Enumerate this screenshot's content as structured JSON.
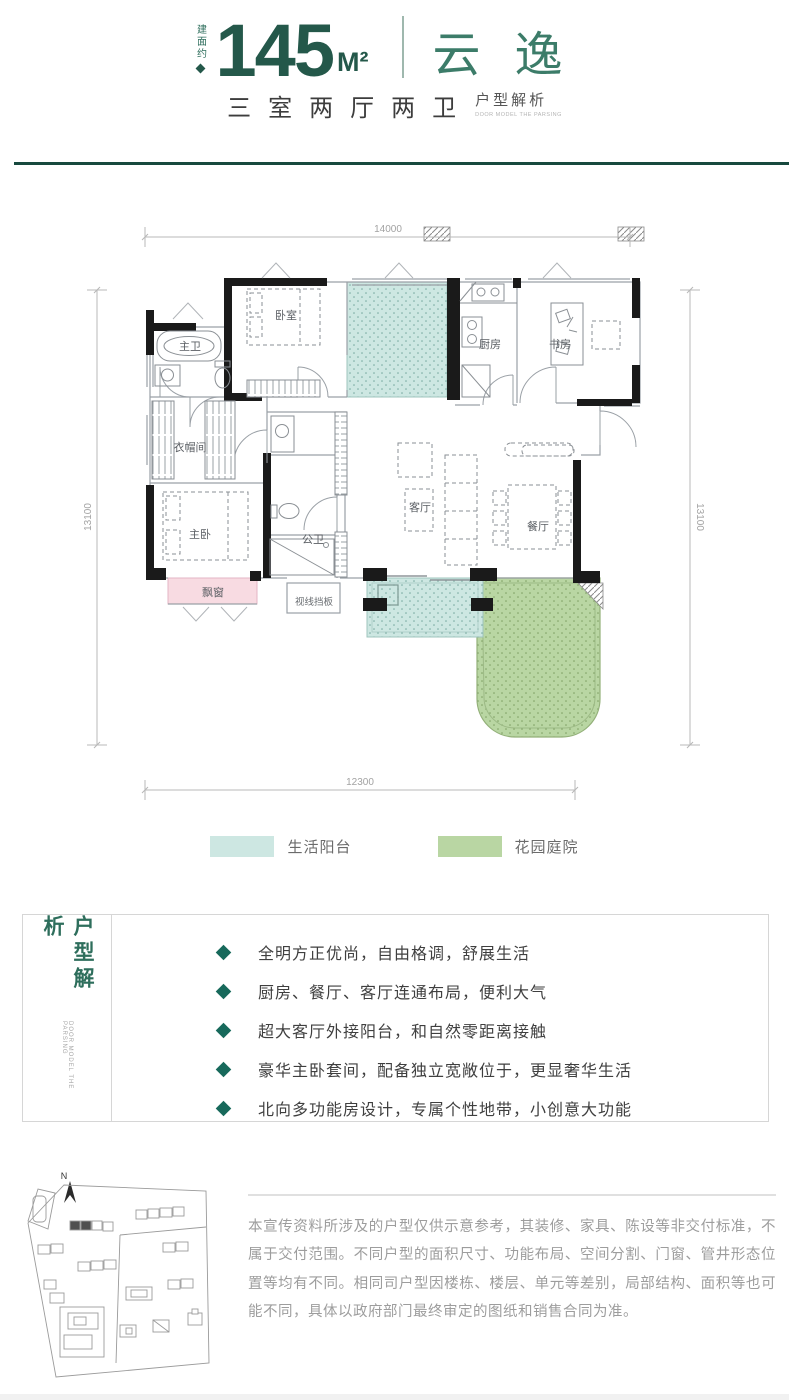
{
  "colors": {
    "accent_dark": "#24584a",
    "accent": "#2e6e5c",
    "rule_green": "#17493e",
    "balcony_teal": "#cde7e2",
    "garden_green": "#b9d6a3",
    "bay_pink": "#f8dbe2",
    "wall_black": "#1a1a1a",
    "bullet_teal": "#17695b"
  },
  "header": {
    "area_label": "建面约",
    "area_value": "145",
    "area_unit": "M²",
    "plan_name": "云逸",
    "subtitle": "三室两厅两卫",
    "subtitle_tag": "户型解析",
    "subtitle_tag_en": "DOOR MODEL THE PARSING"
  },
  "floorplan": {
    "dims": {
      "top": "14000",
      "bottom": "12300",
      "left": "13100",
      "right": "13100"
    },
    "rooms": {
      "master_bath": "主卫",
      "bedroom": "卧室",
      "kitchen": "厨房",
      "study": "书房",
      "cloakroom": "衣帽间",
      "master_bedroom": "主卧",
      "guest_bath": "公卫",
      "living_room": "客厅",
      "dining_room": "餐厅",
      "bay_window": "飘窗",
      "sight_baffle": "视线挡板"
    }
  },
  "legend": {
    "balcony": "生活阳台",
    "garden": "花园庭院"
  },
  "analysis": {
    "title": "户型解析",
    "title_en": "DOOR MODEL THE PARSING",
    "bullets": [
      "全明方正优尚，自由格调，舒展生活",
      "厨房、餐厅、客厅连通布局，便利大气",
      "超大客厅外接阳台，和自然零距离接触",
      "豪华主卧套间，配备独立宽敞位于，更显奢华生活",
      "北向多功能房设计，专属个性地带，小创意大功能"
    ]
  },
  "siteplan": {
    "compass": "N"
  },
  "disclaimer": "本宣传资料所涉及的户型仅供示意参考，其装修、家具、陈设等非交付标准，不属于交付范围。不同户型的面积尺寸、功能布局、空间分割、门窗、管井形态位置等均有不同。相同司户型因楼栋、楼层、单元等差别，局部结构、面积等也可能不同，具体以政府部门最终审定的图纸和销售合同为准。"
}
